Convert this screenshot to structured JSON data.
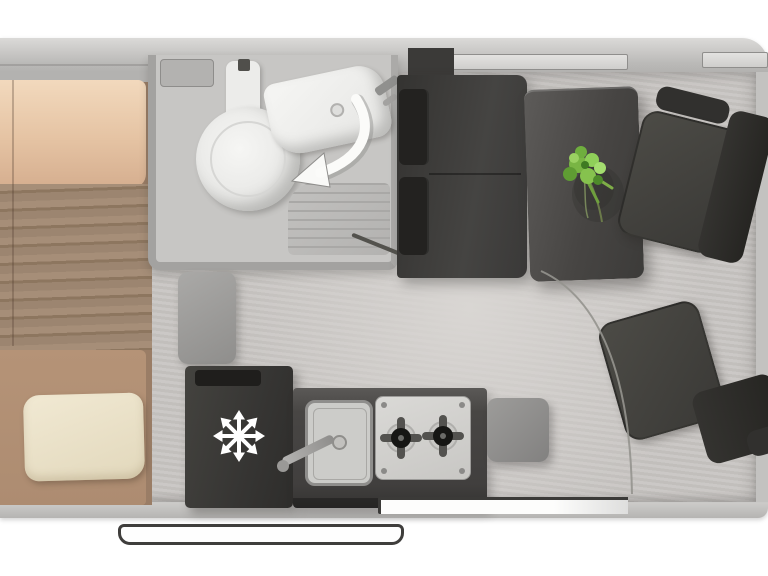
{
  "meta": {
    "title": "Campervan floor plan – top-down view",
    "view": "top-down"
  },
  "palette": {
    "background": "#ffffff",
    "van_wall": "#b6b5b3",
    "floor": "#c9c6c3",
    "dark_furniture": "#3a3938",
    "kitchen_counter": "#474645",
    "bed_duvet": "#ecd0b4",
    "bed_blanket": "#a18971",
    "bed_mattress": "#b69478",
    "pillow": "#ece3cb",
    "fixture_white": "#f2f2f0",
    "plant_green": "#82bf4c",
    "snowflake_white": "#ffffff"
  },
  "rooms": {
    "bedroom": {
      "label": "Rear bedroom with transverse double bed"
    },
    "bathroom": {
      "label": "Washroom with swivel toilet, washbasin and shower tray"
    },
    "lounge": {
      "label": "Dinette with travel bench, table and swivelled cab seats"
    },
    "kitchen": {
      "label": "Kitchenette with fridge, sink and two-burner hob"
    }
  },
  "fixtures": {
    "van_body": {
      "label": "Van body outline"
    },
    "floor": {
      "label": "Vinyl floor"
    },
    "wall_window_rear": {
      "label": "Side window"
    },
    "wall_window_cab": {
      "label": "Cab side window"
    },
    "bed": {
      "label": "Double bed with duvet and folded blanket"
    },
    "pillow": {
      "label": "Pillow"
    },
    "bathroom_shelf": {
      "label": "Bathroom shelf"
    },
    "toilet": {
      "label": "Swivel cassette toilet"
    },
    "toilet_tank": {
      "label": "Toilet cistern"
    },
    "washbasin": {
      "label": "Corner washbasin"
    },
    "basin_tap": {
      "label": "Basin tap"
    },
    "swivel_arrow": {
      "label": "Swivel direction arrow"
    },
    "shower_tray": {
      "label": "Shower tray with drain grooves"
    },
    "bathroom_door": {
      "label": "Washroom door"
    },
    "tall_cabinet": {
      "label": "Tall cabinet"
    },
    "step_pouf": {
      "label": "Step stool"
    },
    "bench_seat": {
      "label": "Forward-facing travel bench"
    },
    "headrest": {
      "label": "Bench headrest"
    },
    "table": {
      "label": "Dinette table"
    },
    "plant": {
      "label": "Potted plant on table"
    },
    "seat_passenger": {
      "label": "Swivelled passenger cab seat"
    },
    "seat_driver": {
      "label": "Swivelled driver cab seat"
    },
    "fridge": {
      "label": "Compressor fridge",
      "icon": "snowflake-icon"
    },
    "kitchen_counter": {
      "label": "Kitchen unit"
    },
    "sink": {
      "label": "Kitchen sink"
    },
    "sink_tap": {
      "label": "Kitchen tap"
    },
    "hob": {
      "label": "Two-burner gas hob",
      "burner_count": 2
    },
    "worktop_flap": {
      "label": "Hinged worktop extension"
    },
    "door_arc": {
      "label": "Door / seat swivel arc"
    },
    "door_opening": {
      "label": "Sliding entry door opening"
    },
    "entry_step": {
      "label": "Exterior entry step"
    }
  }
}
